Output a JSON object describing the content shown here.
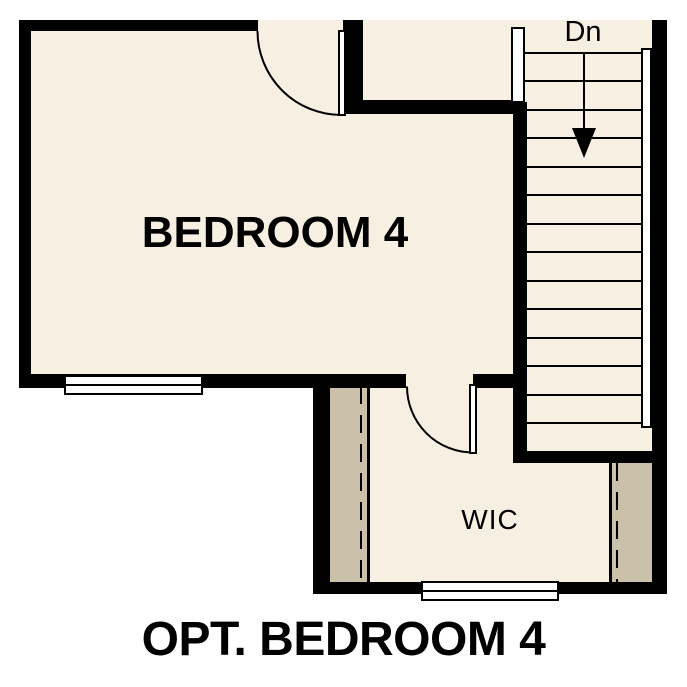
{
  "title": "OPT. BEDROOM 4",
  "rooms": {
    "bedroom": {
      "label": "BEDROOM 4"
    },
    "closet": {
      "label": "WIC"
    },
    "stairs": {
      "label": "Dn",
      "direction": "down",
      "tread_count": 14
    }
  },
  "colors": {
    "background": "#ffffff",
    "floor": "#f6efe2",
    "wall": "#000000",
    "closet_shelf": "#cbc0a9"
  }
}
